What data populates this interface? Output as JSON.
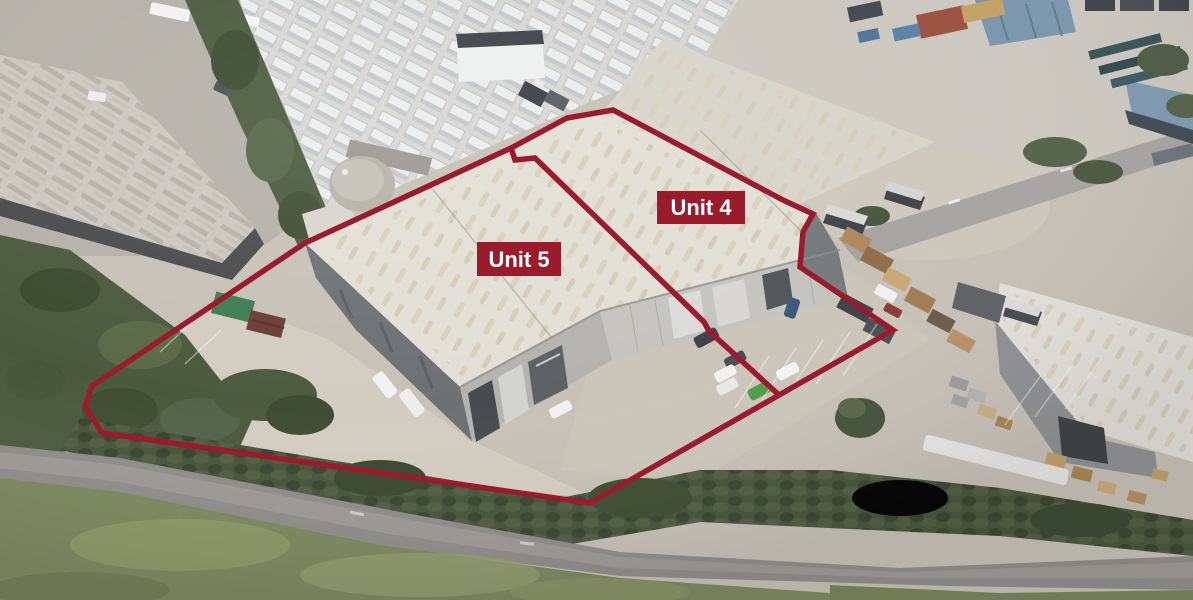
{
  "annotations": {
    "boundary_color": "#9b1b2d",
    "label_bg_color": "#9b1b2d",
    "label_text_color": "#ffffff",
    "units": [
      {
        "id": "unit-4",
        "label": "Unit 4",
        "box_x": 657,
        "box_y": 191,
        "box_w": 88,
        "box_h": 33,
        "text_x": 701,
        "text_y": 215
      },
      {
        "id": "unit-5",
        "label": "Unit 5",
        "box_x": 477,
        "box_y": 242,
        "box_w": 84,
        "box_h": 34,
        "text_x": 519,
        "text_y": 267
      }
    ],
    "outlines": {
      "site": "92,386 305,243 511,148 567,118 613,110 783,200 813,214 803,232 800,267 893,330 590,503 102,433 85,406",
      "divider": "511,148 515,160 535,158 704,322 709,331 779,395"
    }
  }
}
